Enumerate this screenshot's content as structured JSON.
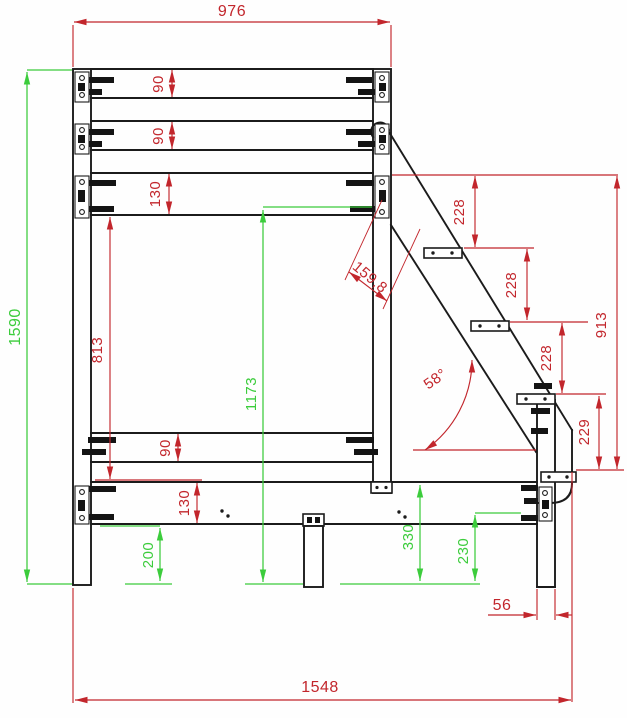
{
  "drawing": {
    "colors": {
      "dimension_red": "#c2262c",
      "dimension_green": "#3ccc3c",
      "line_black": "#1b1b1b",
      "background": "#ffffff"
    },
    "dims": {
      "overall_width_top": "976",
      "overall_height_left": "1590",
      "top_rail_1": "90",
      "top_rail_2": "90",
      "top_rail_3": "130",
      "side_opening_height": "813",
      "platform_underside_height": "1173",
      "stringer_width": "159,8",
      "step_spacing_1": "228",
      "step_spacing_2": "228",
      "step_spacing_3": "228",
      "stair_height": "913",
      "stair_angle": "58°",
      "bottom_step_height": "229",
      "lower_rail_1": "90",
      "lower_rail_2": "130",
      "ground_clearance": "200",
      "underframe_height": "330",
      "stair_leg_height": "230",
      "stringer_offset": "56",
      "overall_length_bottom": "1548"
    }
  }
}
